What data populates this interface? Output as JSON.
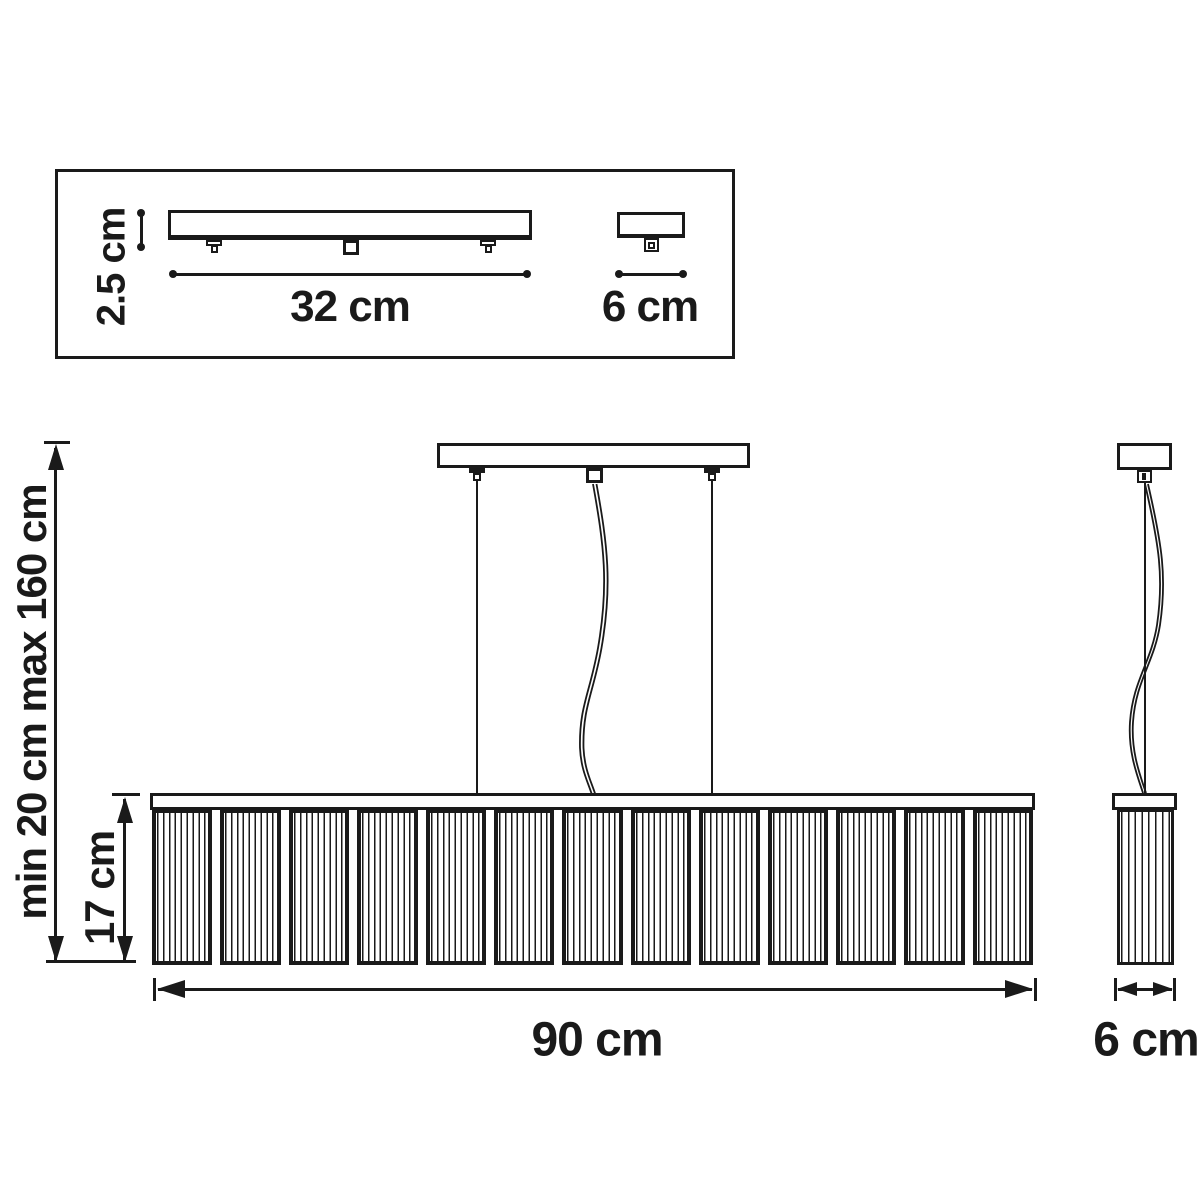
{
  "diagram": {
    "title_hint": "pendant-lamp-dimension-drawing",
    "labels": {
      "plate_height": "2.5 cm",
      "plate_length": "32 cm",
      "plate_side_width": "6 cm",
      "suspension_height": "min 20 cm max 160 cm",
      "shade_height": "17 cm",
      "fixture_length": "90 cm",
      "fixture_side_width": "6 cm"
    },
    "structure": {
      "front_panel_count": 13,
      "panel_rib_lines": 9,
      "side_rib_lines": 7
    },
    "colors": {
      "line": "#1a1a1a",
      "background": "#ffffff"
    }
  }
}
